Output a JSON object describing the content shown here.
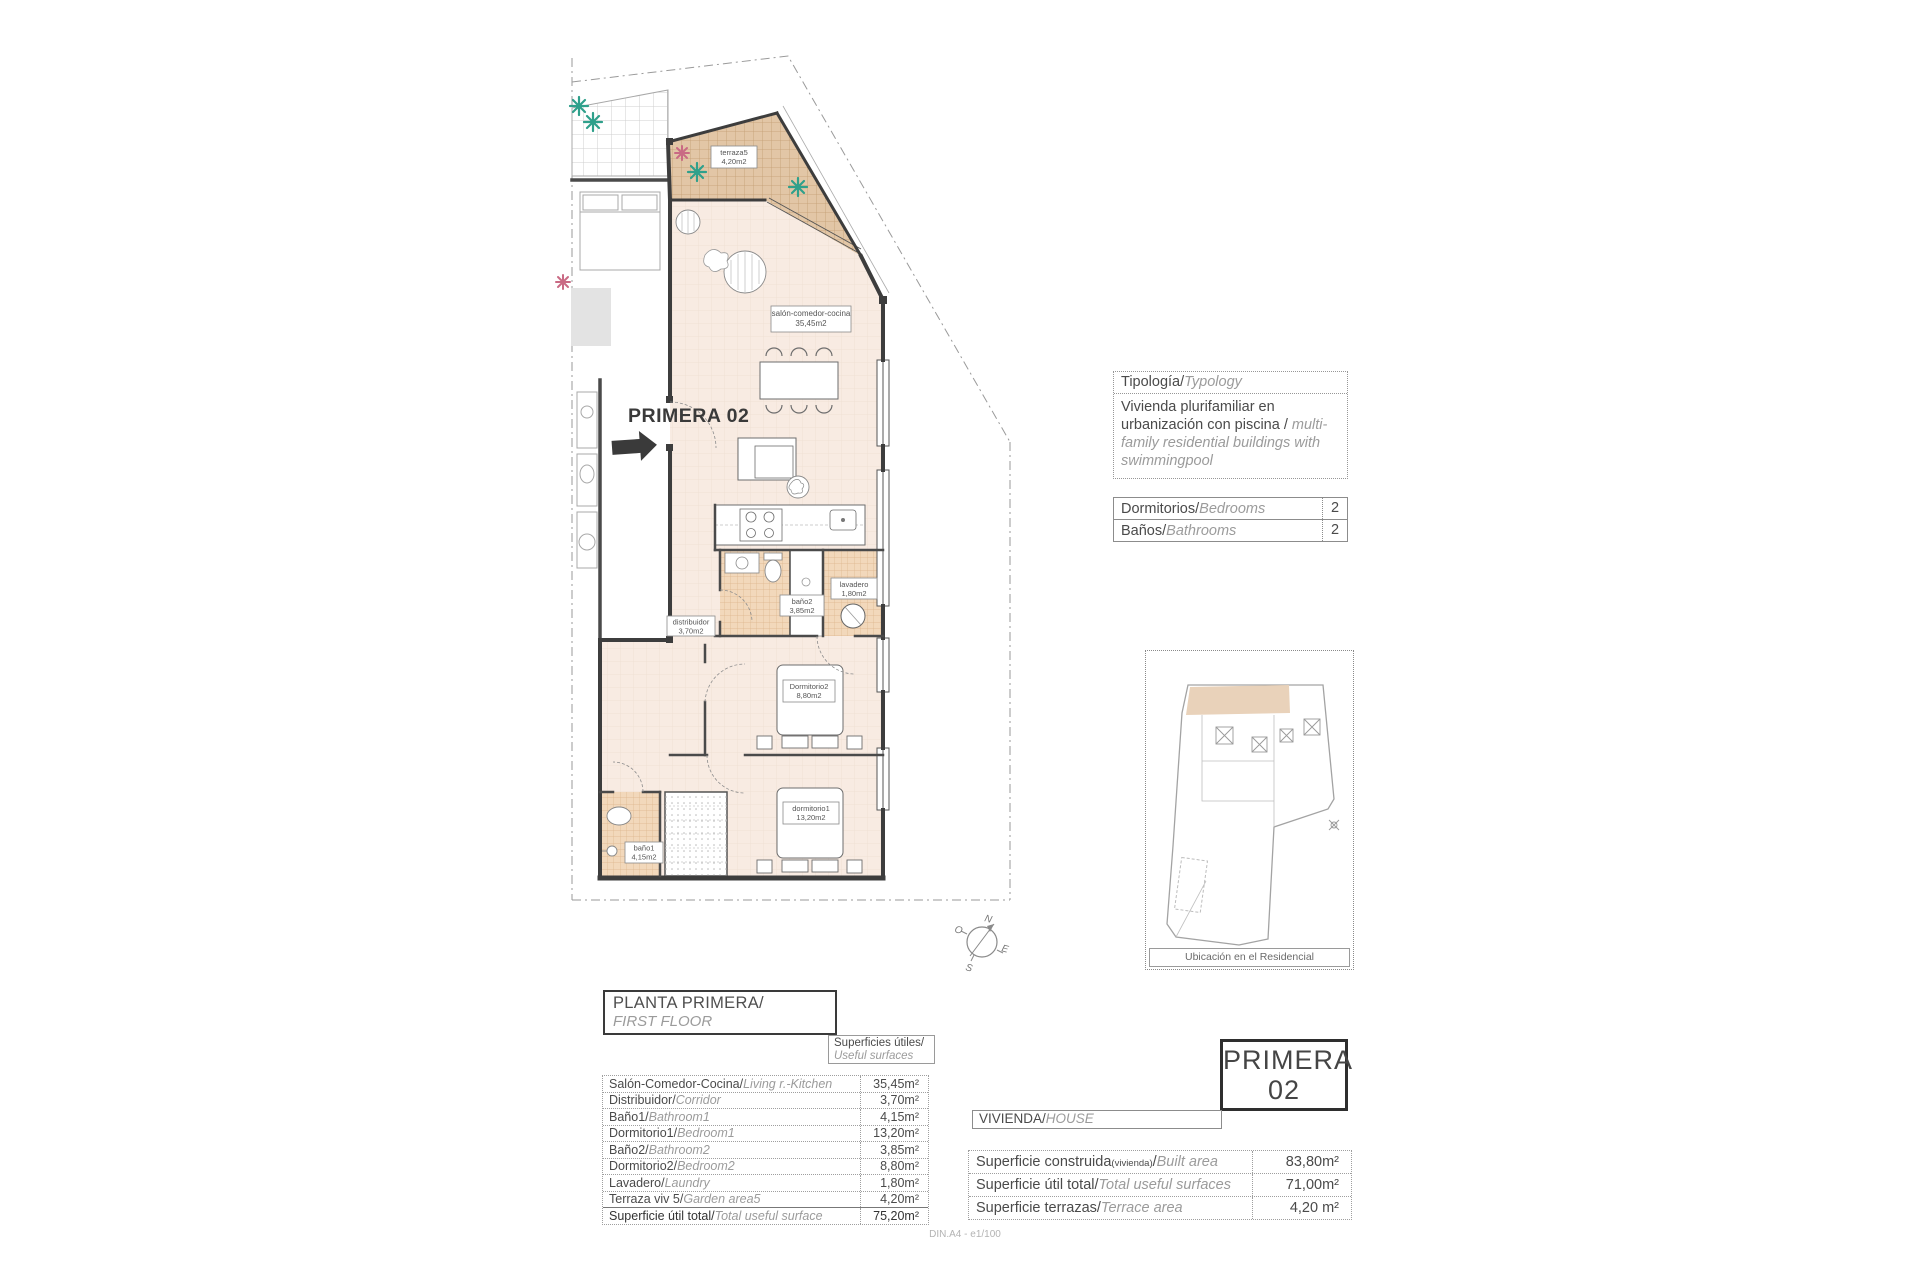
{
  "page": {
    "footer": "DIN.A4 - e1/100"
  },
  "plan": {
    "unit_label": "PRIMERA 02",
    "rooms": {
      "terraza": {
        "name": "terraza5",
        "area": "4,20m2"
      },
      "salon": {
        "name": "salón-comedor-cocina",
        "area": "35,45m2"
      },
      "lavadero": {
        "name": "lavadero",
        "area": "1,80m2"
      },
      "bano2": {
        "name": "baño2",
        "area": "3,85m2"
      },
      "distribuidor": {
        "name": "distribuidor",
        "area": "3,70m2"
      },
      "dormitorio2": {
        "name": "Dormitorio2",
        "area": "8,80m2"
      },
      "dormitorio1": {
        "name": "dormitorio1",
        "area": "13,20m2"
      },
      "bano1": {
        "name": "baño1",
        "area": "4,15m2"
      }
    },
    "compass": {
      "n": "N",
      "s": "S",
      "e": "E",
      "o": "O"
    }
  },
  "typology": {
    "header_es": "Tipología/",
    "header_en": "Typology",
    "body_es": "Vivienda plurifamiliar en urbanización con piscina  /",
    "body_en": "multi-family residential buildings with swimmingpool"
  },
  "counts": {
    "rows": [
      {
        "es": "Dormitorios/",
        "en": "Bedrooms",
        "value": "2"
      },
      {
        "es": "Baños/",
        "en": "Bathrooms",
        "value": "2"
      }
    ]
  },
  "location_map": {
    "caption": "Ubicación en el Residencial"
  },
  "floor_header": {
    "title_es": "PLANTA PRIMERA/",
    "title_en": "FIRST FLOOR",
    "sub_es": "Superficies útiles/",
    "sub_en": "Useful surfaces"
  },
  "floor_table": {
    "rows": [
      {
        "es": "Salón-Comedor-Cocina/",
        "en": "Living r.-Kitchen",
        "value": "35,45m²"
      },
      {
        "es": "Distribuidor/",
        "en": "Corridor",
        "value": "3,70m²"
      },
      {
        "es": "Baño1/",
        "en": "Bathroom1",
        "value": "4,15m²"
      },
      {
        "es": "Dormitorio1/",
        "en": "Bedroom1",
        "value": "13,20m²"
      },
      {
        "es": "Baño2/",
        "en": "Bathroom2",
        "value": "3,85m²"
      },
      {
        "es": "Dormitorio2/",
        "en": "Bedroom2",
        "value": "8,80m²"
      },
      {
        "es": "Lavadero/",
        "en": "Laundry",
        "value": "1,80m²"
      },
      {
        "es": "Terraza viv 5/",
        "en": "Garden area5",
        "value": "4,20m²"
      },
      {
        "es": "Superficie útil total/",
        "en": "Total useful surface",
        "value": "75,20m²"
      }
    ]
  },
  "unit_card": {
    "line1": "PRIMERA",
    "line2": "02"
  },
  "house_header": {
    "es": "VIVIENDA/",
    "en": "HOUSE"
  },
  "house_table": {
    "rows": [
      {
        "es": "Superficie construida",
        "note": "(vivienda)",
        "sep": "/",
        "en": "Built area",
        "value": "83,80m²"
      },
      {
        "es": "Superficie útil total",
        "note": "",
        "sep": "/",
        "en": "Total useful surfaces",
        "value": "71,00m²"
      },
      {
        "es": "Superficie terrazas",
        "note": "",
        "sep": "/",
        "en": "Terrace area",
        "value": "4,20 m²"
      }
    ]
  }
}
